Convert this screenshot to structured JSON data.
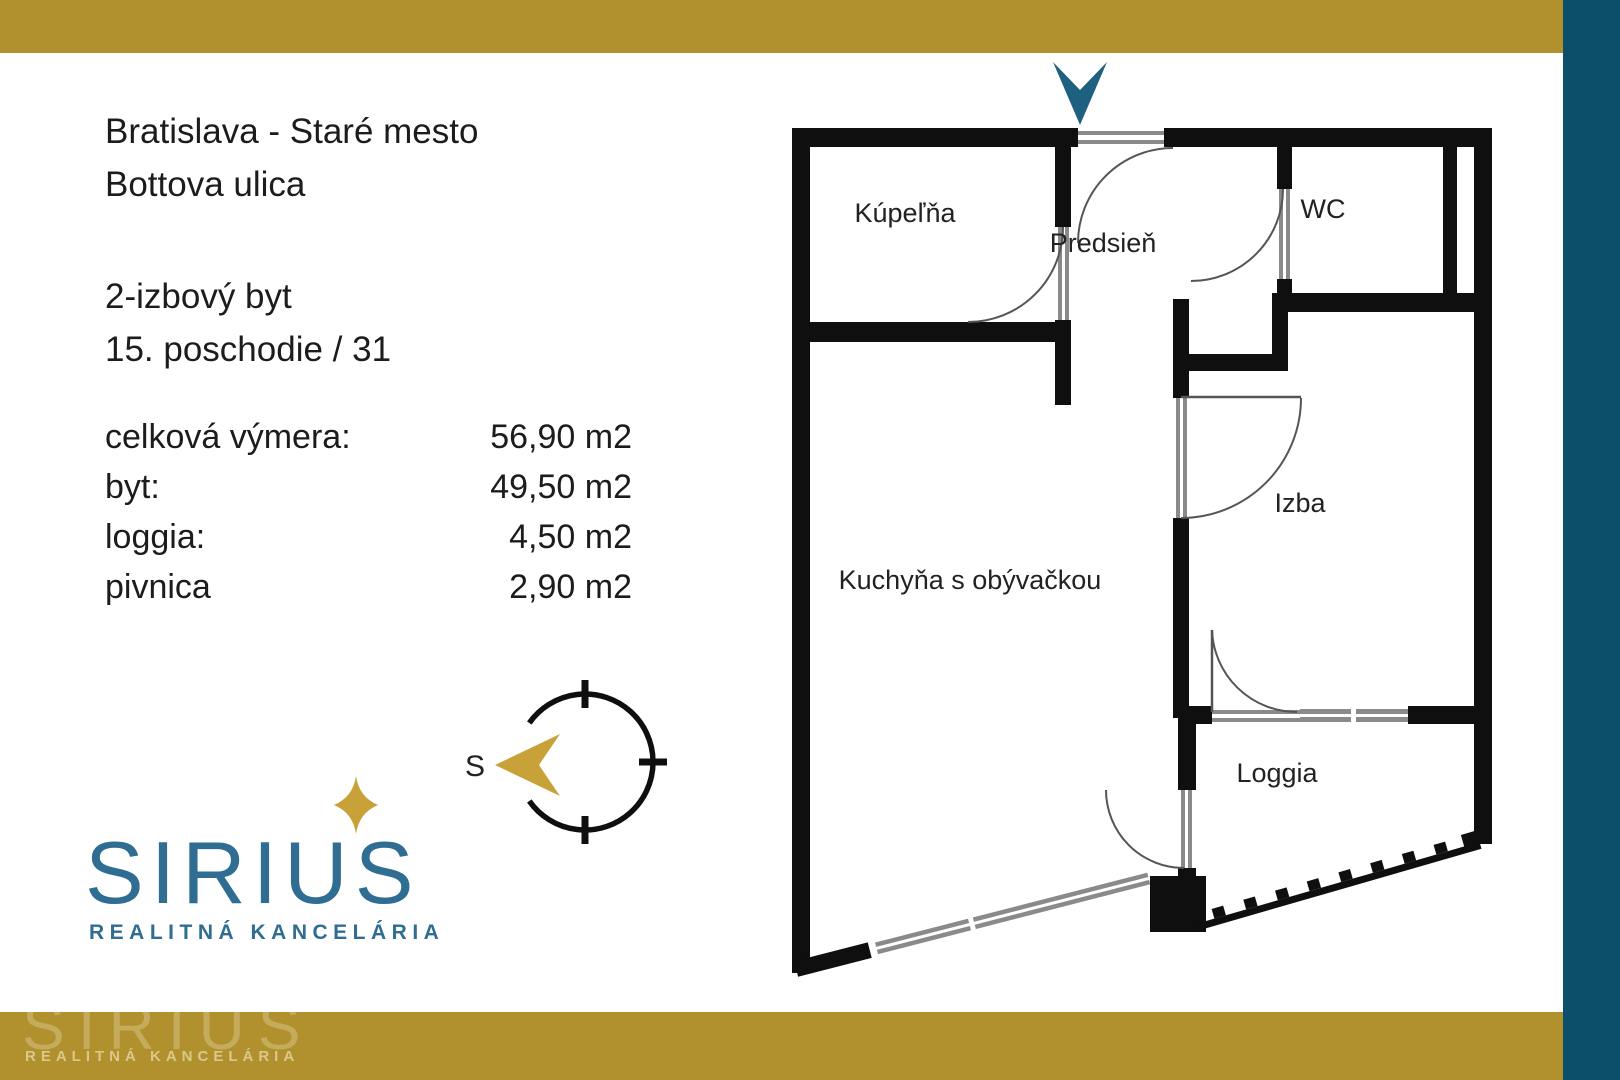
{
  "colors": {
    "gold_bar": "#B1902E",
    "teal_band": "#0B4F6B",
    "entrance_arrow_teal": "#1E607F",
    "logo_teal": "#2F6D92",
    "star_gold": "#C8A238",
    "wall_black": "#0F0F0F",
    "door_gray": "#8a8a8a"
  },
  "left_panel": {
    "location": {
      "line1": "Bratislava - Staré mesto",
      "line2": "Bottova ulica"
    },
    "unit": {
      "line1": "2-izbový byt",
      "line2": "15. poschodie / 31"
    },
    "areas": [
      {
        "label": "celková výmera:",
        "value": "56,90 m2"
      },
      {
        "label": "byt:",
        "value": "49,50 m2"
      },
      {
        "label": "loggia:",
        "value": "4,50 m2"
      },
      {
        "label": "pivnica",
        "value": "2,90 m2"
      }
    ],
    "compass": {
      "direction_label": "S"
    },
    "logo": {
      "name": "SIRIUS",
      "tagline": "REALITNÁ KANCELÁRIA"
    }
  },
  "floor_plan": {
    "rooms": [
      {
        "label": "Kúpeľňa"
      },
      {
        "label": "Predsieň"
      },
      {
        "label": "WC"
      },
      {
        "label": "Izba"
      },
      {
        "label": "Kuchyňa s obývačkou"
      },
      {
        "label": "Loggia"
      }
    ]
  },
  "watermark": {
    "name": "SIRIUS",
    "tagline": "REALITNÁ KANCELÁRIA"
  }
}
